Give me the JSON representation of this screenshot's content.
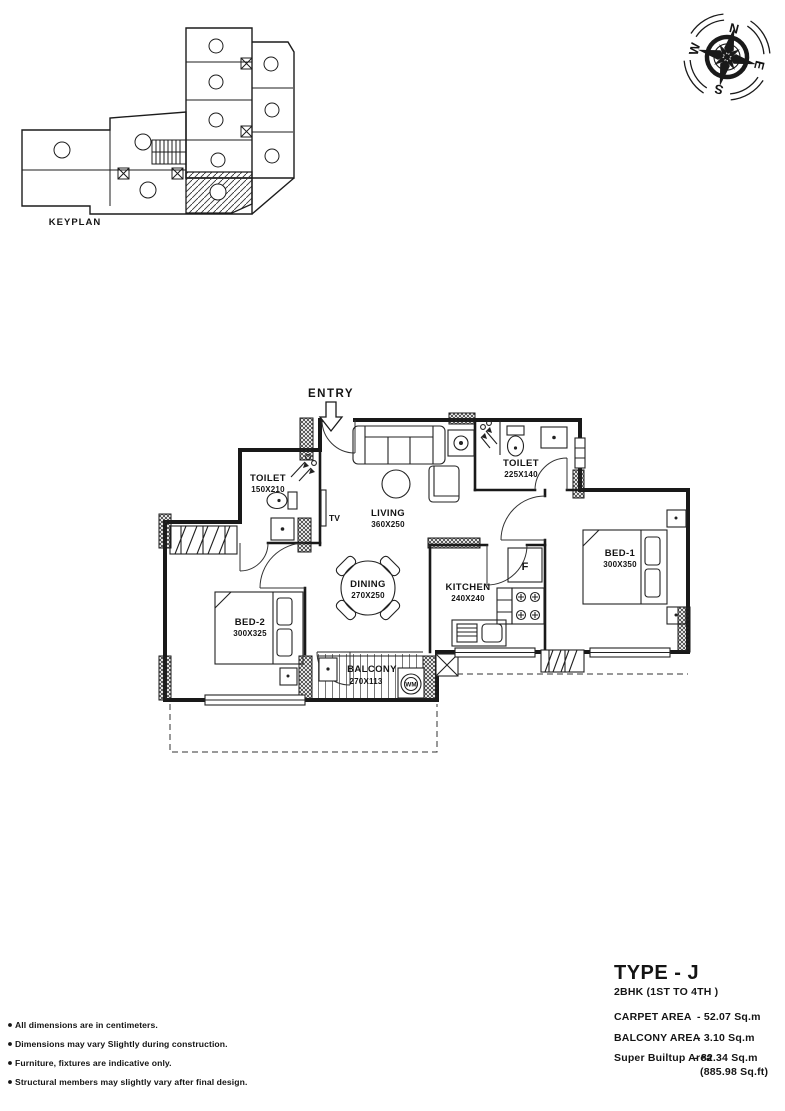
{
  "keyplan": {
    "label": "KEYPLAN"
  },
  "compass": {
    "n": "N",
    "e": "E",
    "s": "S",
    "w": "W"
  },
  "plan": {
    "entry_label": "ENTRY",
    "tv_label": "TV",
    "fridge_label": "F",
    "wm_label": "WM",
    "rooms": {
      "living": {
        "name": "LIVING",
        "dim": "360X250"
      },
      "dining": {
        "name": "DINING",
        "dim": "270X250"
      },
      "kitchen": {
        "name": "KITCHEN",
        "dim": "240X240"
      },
      "bed1": {
        "name": "BED-1",
        "dim": "300X350"
      },
      "bed2": {
        "name": "BED-2",
        "dim": "300X325"
      },
      "toilet1": {
        "name": "TOILET",
        "dim": "150X210"
      },
      "toilet2": {
        "name": "TOILET",
        "dim": "225X140"
      },
      "balcony": {
        "name": "BALCONY",
        "dim": "270X113"
      }
    }
  },
  "info": {
    "type_title": "TYPE - J",
    "subtitle": "2BHK (1ST TO 4TH )",
    "rows": [
      {
        "label": "CARPET AREA",
        "value": "- 52.07 Sq.m"
      },
      {
        "label": "BALCONY AREA",
        "value": "- 3.10 Sq.m"
      },
      {
        "label": "Super Builtup Area",
        "value": "- 82.34 Sq.m"
      },
      {
        "label": "",
        "value": "(885.98 Sq.ft)"
      }
    ]
  },
  "notes": [
    "All dimensions are in centimeters.",
    "Dimensions may vary Slightly during construction.",
    "Furniture, fixtures are indicative only.",
    "Structural members may slightly vary after final design."
  ]
}
